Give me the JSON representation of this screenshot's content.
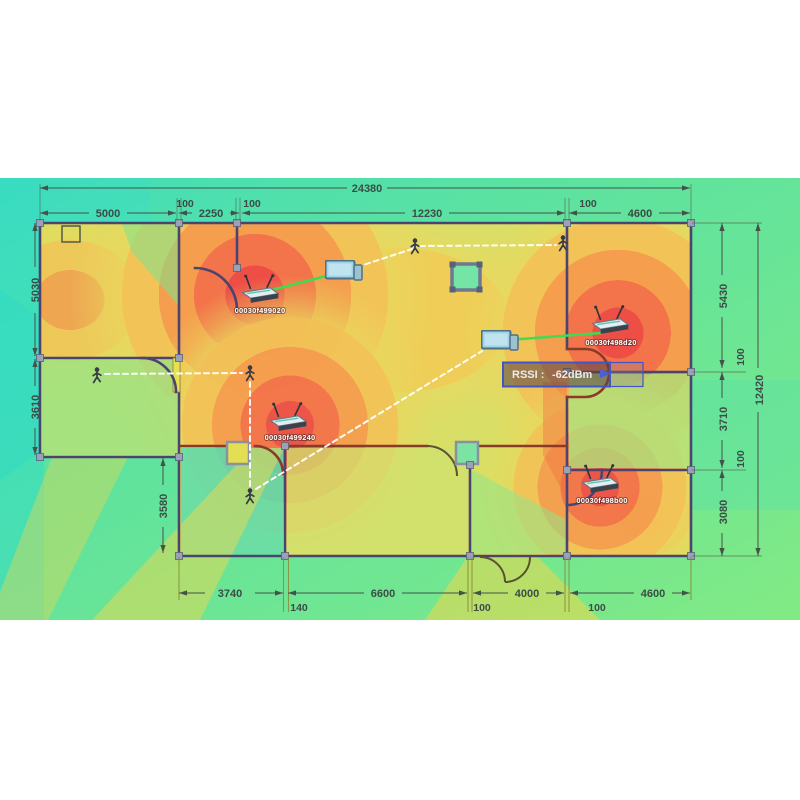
{
  "dimensions": {
    "total_width": "24380",
    "total_height": "12420",
    "top": {
      "room_left": "5000",
      "wall_1": "100",
      "stairwell": "2250",
      "wall_2": "100",
      "hall": "12230",
      "wall_3": "100",
      "room_right": "4600"
    },
    "left": {
      "upper": "5030",
      "lower": "3610",
      "inner": "3580"
    },
    "right": {
      "upper": "5430",
      "wall_1": "100",
      "middle": "3710",
      "wall_2": "100",
      "lower": "3080"
    },
    "bottom": {
      "seg_1": "3740",
      "wall_1": "140",
      "seg_2": "6600",
      "wall_2": "100",
      "seg_3": "4000",
      "wall_3": "100",
      "seg_4": "4600"
    }
  },
  "access_points": [
    {
      "mac": "00030f499020"
    },
    {
      "mac": "00030f498d20"
    },
    {
      "mac": "00030f499240"
    },
    {
      "mac": "00030f498b00"
    }
  ],
  "tooltip": {
    "label": "RSSI :",
    "value": "-62dBm"
  },
  "colors": {
    "signal_hot": "#ed4f47",
    "signal_warm": "#f59e4e",
    "signal_mid": "#f2c357",
    "signal_cool": "#7ce787",
    "signal_cold": "#3eddc6",
    "link_line": "#3fdc4f",
    "tooltip_border": "#4254c6",
    "wall": "#4a4470",
    "dimension_text": "#3c4c46"
  },
  "icons": [
    "router-icon",
    "person-icon",
    "laptop-icon",
    "column-icon"
  ]
}
